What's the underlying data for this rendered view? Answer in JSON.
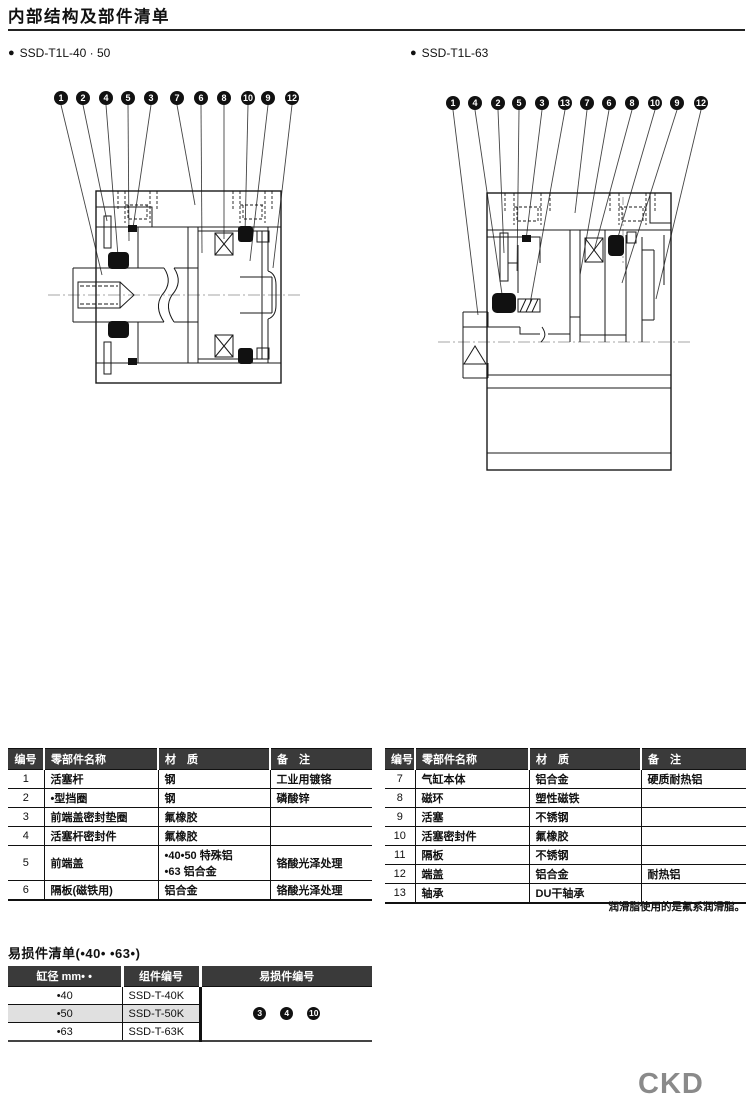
{
  "page": {
    "title": "内部结构及部件清单",
    "grease_note": "润滑脂使用的是氟系润滑脂。",
    "logo": "CKD"
  },
  "icons": {
    "bullet": "●"
  },
  "diagrams": {
    "left": {
      "label": "SSD-T1L-40 · 50",
      "callouts": [
        "1",
        "2",
        "4",
        "5",
        "3",
        "7",
        "6",
        "8",
        "10",
        "9",
        "12"
      ]
    },
    "right": {
      "label": "SSD-T1L-63",
      "callouts": [
        "1",
        "4",
        "2",
        "5",
        "3",
        "13",
        "7",
        "6",
        "8",
        "10",
        "9",
        "12"
      ]
    }
  },
  "parts_table": {
    "headers": [
      "编号",
      "零部件名称",
      "材　质",
      "备　注"
    ],
    "left_rows": [
      {
        "no": "1",
        "name": "活塞杆",
        "material": "钢",
        "note": "工业用镀铬"
      },
      {
        "no": "2",
        "name": "•型挡圈",
        "material": "钢",
        "note": "磷酸锌"
      },
      {
        "no": "3",
        "name": "前端盖密封垫圈",
        "material": "氟橡胶",
        "note": ""
      },
      {
        "no": "4",
        "name": "活塞杆密封件",
        "material": "氟橡胶",
        "note": ""
      },
      {
        "no": "5",
        "name": "前端盖",
        "material": [
          "•40•50 特殊铝",
          "•63 铝合金"
        ],
        "note": "铬酸光泽处理"
      },
      {
        "no": "6",
        "name": "隔板(磁铁用)",
        "material": "铝合金",
        "note": "铬酸光泽处理"
      }
    ],
    "right_rows": [
      {
        "no": "7",
        "name": "气缸本体",
        "material": "铝合金",
        "note": "硬质耐热铝"
      },
      {
        "no": "8",
        "name": "磁环",
        "material": "塑性磁铁",
        "note": ""
      },
      {
        "no": "9",
        "name": "活塞",
        "material": "不锈钢",
        "note": ""
      },
      {
        "no": "10",
        "name": "活塞密封件",
        "material": "氟橡胶",
        "note": ""
      },
      {
        "no": "11",
        "name": "隔板",
        "material": "不锈钢",
        "note": ""
      },
      {
        "no": "12",
        "name": "端盖",
        "material": "铝合金",
        "note": "耐热铝"
      },
      {
        "no": "13",
        "name": "轴承",
        "material": "DU干轴承",
        "note": ""
      }
    ]
  },
  "wear_section": {
    "title": "易损件清单(•40• •63•)",
    "headers": [
      "缸径 mm• •",
      "组件编号",
      "易损件编号"
    ],
    "rows": [
      {
        "bore": "•40",
        "kit": "SSD-T-40K",
        "highlight": false
      },
      {
        "bore": "•50",
        "kit": "SSD-T-50K",
        "highlight": true
      },
      {
        "bore": "•63",
        "kit": "SSD-T-63K",
        "highlight": false
      }
    ],
    "badges": [
      "3",
      "4",
      "10"
    ]
  }
}
